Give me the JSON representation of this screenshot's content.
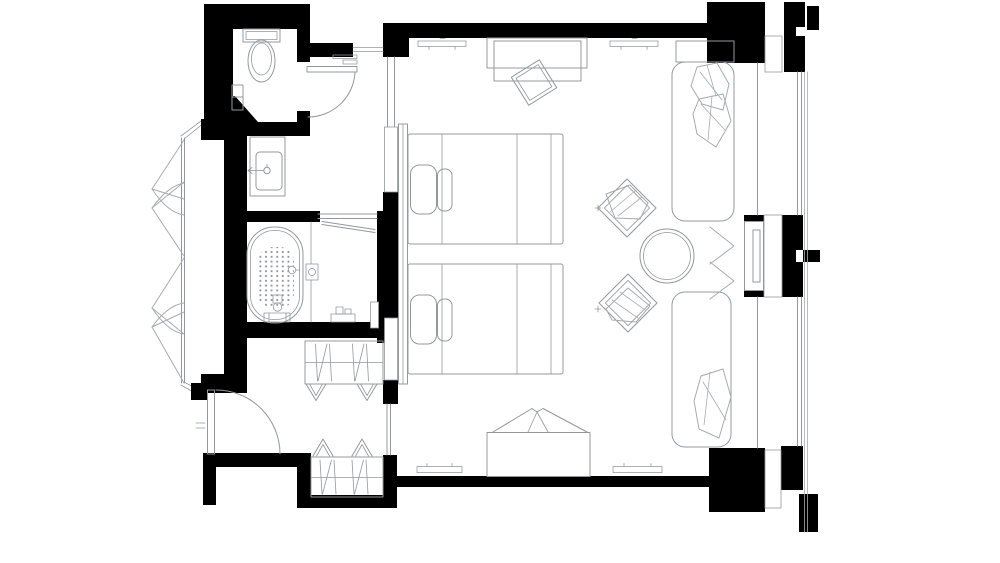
{
  "colors": {
    "wall": "#000000",
    "line": "#94989c",
    "furniture": "#a8abae",
    "background": "#ffffff"
  },
  "floor_plan": {
    "type": "hotel-guest-room-plan",
    "rooms": [
      {
        "id": "wc",
        "name": "wc",
        "fixtures": [
          "toilet",
          "wall-shelf",
          "swing-door"
        ]
      },
      {
        "id": "vanity",
        "name": "vanity",
        "fixtures": [
          "counter",
          "basin",
          "faucet"
        ]
      },
      {
        "id": "bathroom",
        "name": "bathroom",
        "fixtures": [
          "bathtub",
          "anti-slip-dot-mat",
          "glass-partition",
          "pivot-shower-door",
          "floor-drain",
          "wall-niche",
          "bath-mixer"
        ]
      },
      {
        "id": "dressing",
        "name": "dressing-area",
        "fixtures": [
          "luggage-bench"
        ]
      },
      {
        "id": "entry",
        "name": "entry",
        "fixtures": [
          "entry-door",
          "luggage-bench"
        ]
      },
      {
        "id": "sleeping",
        "name": "sleeping-area",
        "fixtures": [
          "twin-bed",
          "twin-bed",
          "headboard-panel",
          "ceiling-marks"
        ]
      },
      {
        "id": "lounge",
        "name": "lounge",
        "fixtures": [
          "console-desk",
          "stool",
          "round-table",
          "armchair",
          "armchair",
          "daybed-upper",
          "daybed-lower",
          "bench-with-folded-throw",
          "wall-diffusers",
          "curtain-chevrons"
        ]
      }
    ],
    "windows": [
      "left-casement-bay",
      "right-glazing-upper",
      "right-glazing-lower",
      "interior-glazed-partition"
    ],
    "wall_style": "solid-black-poche",
    "pier_fill": "loop-insulation-hatch"
  }
}
